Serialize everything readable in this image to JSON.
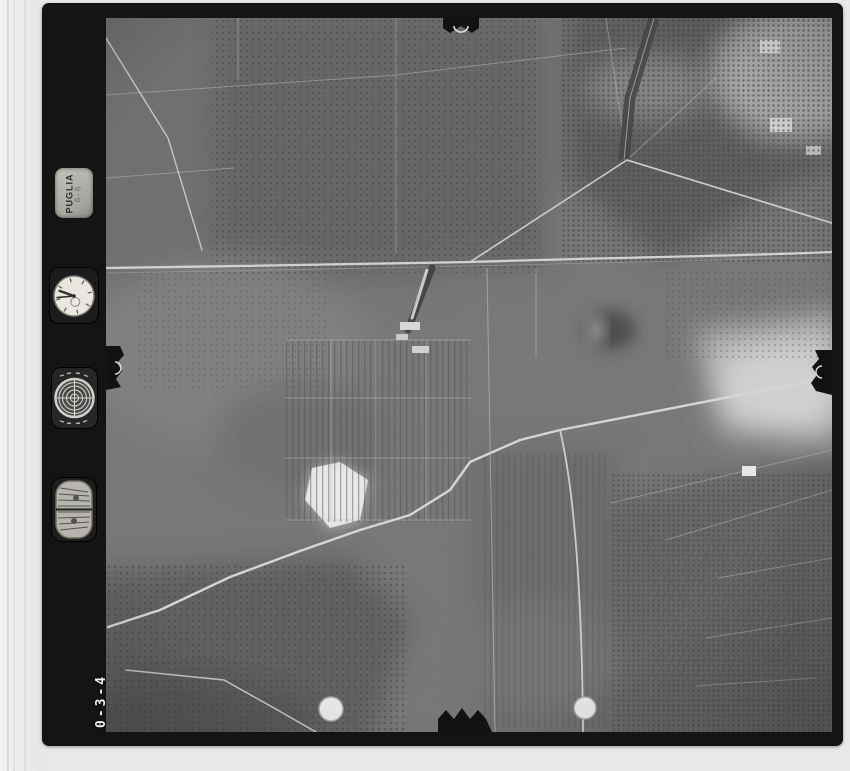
{
  "page": {
    "background": "#e8e8e6",
    "frame_color": "#141414"
  },
  "photo": {
    "kind": "black-and-white vertical aerial survey photograph",
    "tones": {
      "base": "#616161",
      "orchard_dark": "#474747",
      "bare_field_white": "#e9e9e9",
      "road_light": "#d4d4d4"
    }
  },
  "marginalia": {
    "plate_text": "PUGLIA",
    "plate_code": "6-6",
    "frame_number": "0-3-4",
    "instruments": [
      {
        "name": "data-plate",
        "label": "PUGLIA"
      },
      {
        "name": "clock-instrument",
        "label": ""
      },
      {
        "name": "bullseye-level",
        "label": ""
      },
      {
        "name": "altimeter-gauge",
        "label": ""
      }
    ]
  },
  "fiducials": {
    "positions": [
      "top-center",
      "left-center",
      "right-center",
      "bottom-center"
    ],
    "mark_color": "#dddddd"
  },
  "punch_dots": {
    "count": 2,
    "color": "#f2f2ef"
  }
}
